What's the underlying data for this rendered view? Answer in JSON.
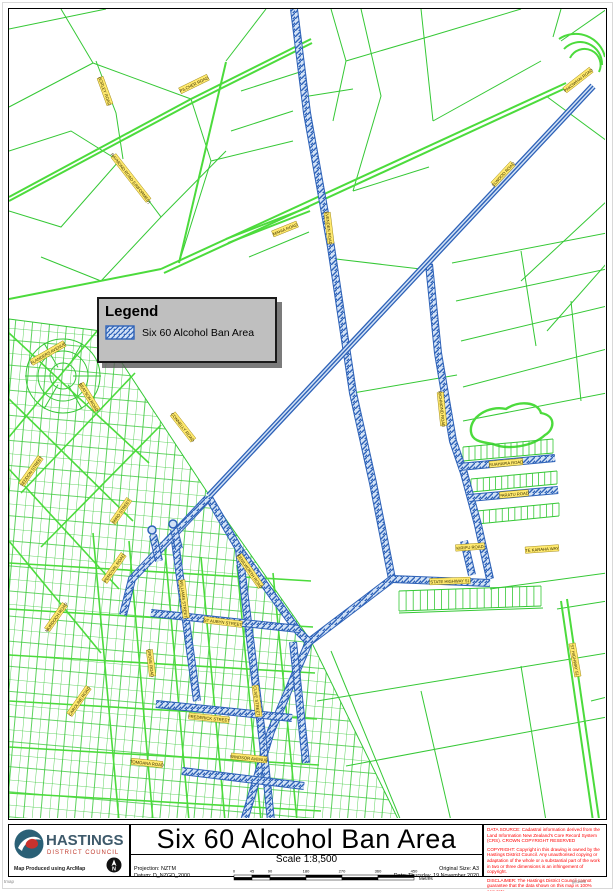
{
  "legend": {
    "title": "Legend",
    "item_label": "Six 60 Alcohol Ban Area"
  },
  "footer": {
    "title": "Six 60 Alcohol Ban Area",
    "scale_label": "Scale 1:8,500",
    "projection": "Projection: NZTM",
    "datum": "Datum: D_NZGD_2000",
    "original_size": "Original Size: A3",
    "date": "Date: Thursday, 19 November 2020",
    "produced": "Map Produced using ArcMap",
    "scalebar": {
      "ticks": [
        0,
        45,
        90,
        180,
        270,
        360,
        450
      ],
      "unit": "Metres"
    },
    "notices": [
      "DATA SOURCE: Cadastral information derived from the Land Information New Zealand's Core Record System (CRS). CROWN COPYRIGHT RESERVED",
      "COPYRIGHT: Copyright in this drawing is owned by the Hastings District Council. Any unauthorised copying or adaptation of the whole or a substantial part of the work in two or three dimensions is an infringement of copyright.",
      "DISCLAIMER: The Hastings District Council cannot guarantee that the data shown on this map is 100% accurate."
    ],
    "micro_left": "tmap",
    "micro_right": "gisweb"
  },
  "logo": {
    "name": "HASTINGS",
    "sub": "DISTRICT COUNCIL",
    "north_label": "N"
  },
  "map": {
    "colors": {
      "green": "#35c835",
      "green_bright": "#4cdb3c",
      "ban_edge": "#2e62b8",
      "ban_fill": "#d2e2f6",
      "label_bg": "#ffe96e",
      "label_border": "#8f7700",
      "label_text": "#3a3000"
    },
    "green_thin": [
      "M8,28 L105,8",
      "M60,8 L92,62 L8,106",
      "M92,62 L190,98",
      "M8,150 L70,130 L118,160 L60,226 L8,210",
      "M118,160 L160,216 L100,280 L40,256",
      "M160,216 L225,150",
      "M95,60 L115,112 L122,158",
      "M190,98 L210,160 L178,262",
      "M225,60 L265,8",
      "M240,90 L302,70",
      "M230,130 L292,110",
      "M210,160 L292,140",
      "M248,256 L308,231",
      "M308,95 L352,88",
      "M330,8 L345,60 L332,120",
      "M360,8 L380,95 L352,190",
      "M420,8 L432,120",
      "M345,60 L430,35",
      "M352,190 L428,166",
      "M430,35 L520,8",
      "M432,120 L540,60",
      "M606,8 L560,40",
      "M545,95 L606,140",
      "M606,200 L520,280",
      "M606,262 L546,330",
      "M560,8 L552,36",
      "M451,262 L606,232",
      "M455,300 L606,268",
      "M460,340 L606,305",
      "M462,386 L606,348",
      "M520,250 L535,345",
      "M570,300 L580,400",
      "M462,420 L606,392",
      "M335,258 L428,269",
      "M352,392 L456,374",
      "M316,700 L606,652",
      "M345,765 L606,716",
      "M330,650 L400,820",
      "M420,690 L450,820",
      "M520,665 L545,820",
      "M398,612 L542,607",
      "M489,588 L606,572",
      "M556,608 L606,600",
      "M590,700 L606,696"
    ],
    "green_thick": [
      "M160,268 L565,82",
      "M163,272 L567,86",
      "M8,196 L190,98 L310,38",
      "M8,200 L191,102 L311,42",
      "M8,298 L160,268",
      "M178,262 L225,61",
      "M560,600 L592,820",
      "M566,598 L598,818",
      "M558,38 A30,30 0 0 1 604,56",
      "M563,48 A22,22 0 0 1 601,64",
      "M569,57 A15,15 0 0 1 598,71",
      "M225,238 L308,206",
      "M227,242 L309,210"
    ],
    "pond": "M470,431 C468,416 488,404 505,408 C518,399 537,401 540,412 C556,415 553,429 544,434 C531,446 506,449 492,443 C478,441 471,439 470,431 Z",
    "combs": [
      {
        "x1": 462,
        "y1": 446,
        "x2": 552,
        "y2": 438,
        "len": 14,
        "gap": 6
      },
      {
        "x1": 470,
        "y1": 478,
        "x2": 556,
        "y2": 470,
        "len": 13,
        "gap": 6
      },
      {
        "x1": 476,
        "y1": 510,
        "x2": 558,
        "y2": 502,
        "len": 13,
        "gap": 6
      },
      {
        "x1": 398,
        "y1": 590,
        "x2": 540,
        "y2": 585,
        "len": 20,
        "gap": 7
      }
    ],
    "urban": {
      "region": "8,318 100,330 210,497 310,640 398,820 8,820",
      "streets": [
        "M8,332 L148,462",
        "M8,398 L132,520",
        "M8,468 L118,588",
        "M8,540 L100,652",
        "M96,330 L8,436",
        "M134,372 L20,492",
        "M160,424 L40,546",
        "M92,532 L118,820",
        "M128,540 L152,820",
        "M164,548 L188,820",
        "M200,556 L224,820",
        "M236,564 L260,820",
        "M272,572 L296,820",
        "M8,562 L310,580",
        "M8,608 L312,626",
        "M8,654 L314,672",
        "M8,700 L316,718",
        "M8,746 L318,764",
        "M8,792 L320,810"
      ]
    },
    "crescent": {
      "cx": 62,
      "cy": 375,
      "radii": [
        13,
        25,
        37
      ]
    },
    "ban_bands": [
      "M293,8 L306,112 L330,246 L352,392 L372,482 L391,578",
      "M428,263 L437,352 L452,440 L463,472 L477,524 L489,578",
      "M458,466 L554,457",
      "M468,497 L557,489",
      "M463,540 L471,574",
      "M391,578 L489,582",
      "M391,578 L308,641",
      "M207,495 L238,548 L297,630 L308,641",
      "M308,641 L270,730 L243,820",
      "M207,497 L131,578 L122,614",
      "M174,540 L196,700",
      "M238,549 L262,742 L270,820",
      "M150,612 L298,628",
      "M155,703 L291,717",
      "M181,770 L303,785",
      "M292,641 L305,762",
      "M158,560 L152,534",
      "M178,548 L173,528"
    ],
    "ban_roads": [
      "M592,85 L208,495"
    ],
    "bulbs": [
      {
        "cx": 151,
        "cy": 529,
        "r": 4
      },
      {
        "cx": 172,
        "cy": 523,
        "r": 4
      }
    ],
    "labels": [
      {
        "t": "PILCHER ROAD",
        "x": 193,
        "y": 83,
        "r": -26
      },
      {
        "t": "BORLEY ROAD",
        "x": 104,
        "y": 90,
        "r": 70
      },
      {
        "t": "RAYMOND ROAD (UNFORMED)",
        "x": 130,
        "y": 177,
        "r": 52
      },
      {
        "t": "MAHIA ROAD",
        "x": 284,
        "y": 228,
        "r": -22
      },
      {
        "t": "PAKOWHAI ROAD",
        "x": 577,
        "y": 79,
        "r": -38
      },
      {
        "t": "ELWOOD ROAD",
        "x": 502,
        "y": 173,
        "r": -47
      },
      {
        "t": "EVENDEN ROAD",
        "x": 328,
        "y": 227,
        "r": 83
      },
      {
        "t": "RICHMOND ROAD",
        "x": 441,
        "y": 408,
        "r": 84
      },
      {
        "t": "RUAHAPIA ROAD",
        "x": 505,
        "y": 462,
        "r": -5
      },
      {
        "t": "PARATU ROAD",
        "x": 513,
        "y": 493,
        "r": -5
      },
      {
        "t": "KIRIPU ROAD",
        "x": 469,
        "y": 546,
        "r": -4
      },
      {
        "t": "TE KARAHA WAY",
        "x": 541,
        "y": 548,
        "r": -4
      },
      {
        "t": "STATE HIGHWAY 51",
        "x": 449,
        "y": 580,
        "r": -2
      },
      {
        "t": "ST HIGHWAY 51",
        "x": 574,
        "y": 659,
        "r": 80
      },
      {
        "t": "CONNELLY ROAD",
        "x": 182,
        "y": 426,
        "r": 52
      },
      {
        "t": "KENILWORTH ROAD",
        "x": 249,
        "y": 570,
        "r": 55
      },
      {
        "t": "WILLIAMS STREET",
        "x": 183,
        "y": 598,
        "r": 83
      },
      {
        "t": "ST AUBYN STREET",
        "x": 222,
        "y": 621,
        "r": 7
      },
      {
        "t": "GROVE ROAD",
        "x": 150,
        "y": 662,
        "r": 83
      },
      {
        "t": "FREDERICK STREET",
        "x": 208,
        "y": 717,
        "r": 6
      },
      {
        "t": "CLIVE STREET",
        "x": 256,
        "y": 700,
        "r": 83
      },
      {
        "t": "MURDOCH ROAD",
        "x": 55,
        "y": 616,
        "r": -55
      },
      {
        "t": "PERCIVAL ROAD",
        "x": 113,
        "y": 567,
        "r": -55
      },
      {
        "t": "CAROLINE ROAD",
        "x": 78,
        "y": 700,
        "r": -55
      },
      {
        "t": "TOMOANA ROAD",
        "x": 146,
        "y": 762,
        "r": 6
      },
      {
        "t": "WINDSOR AVENUE",
        "x": 248,
        "y": 757,
        "r": 6
      },
      {
        "t": "FLANDERS AVENUE",
        "x": 47,
        "y": 352,
        "r": -30
      },
      {
        "t": "BEATSON ROAD",
        "x": 88,
        "y": 396,
        "r": 58
      },
      {
        "t": "SEDDON STREET",
        "x": 30,
        "y": 470,
        "r": -55
      },
      {
        "t": "MIRO STREET",
        "x": 120,
        "y": 510,
        "r": -55
      }
    ]
  }
}
